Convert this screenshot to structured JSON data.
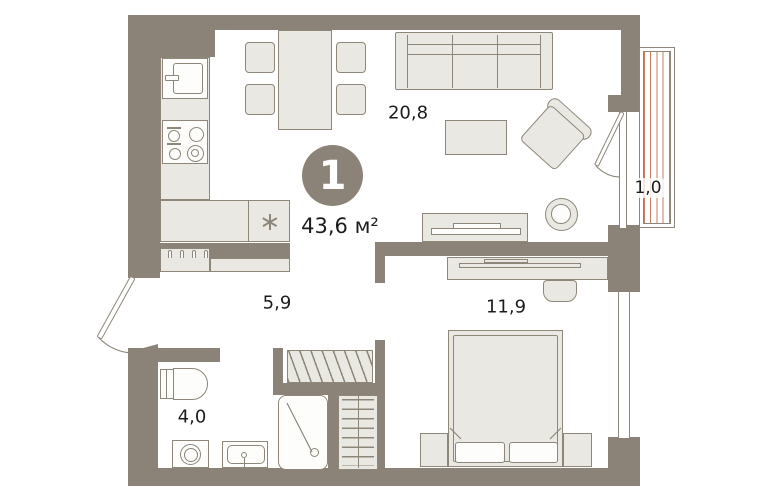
{
  "unit": {
    "rooms_count": "1",
    "total_area": "43,6 м²"
  },
  "rooms": {
    "living": {
      "label": "20,8"
    },
    "balcony": {
      "label": "1,0"
    },
    "hallway": {
      "label": "5,9"
    },
    "bedroom": {
      "label": "11,9"
    },
    "bathroom": {
      "label": "4,0"
    }
  },
  "colors": {
    "wall": "#8b8377",
    "furniture_fill": "#eae8e3",
    "fixture_fill": "#fdfdfc",
    "outline": "#8e8779",
    "balcony_hatch": "#c97c5c",
    "text": "#1c1c1c",
    "badge_text": "#ffffff",
    "background": "#ffffff"
  }
}
